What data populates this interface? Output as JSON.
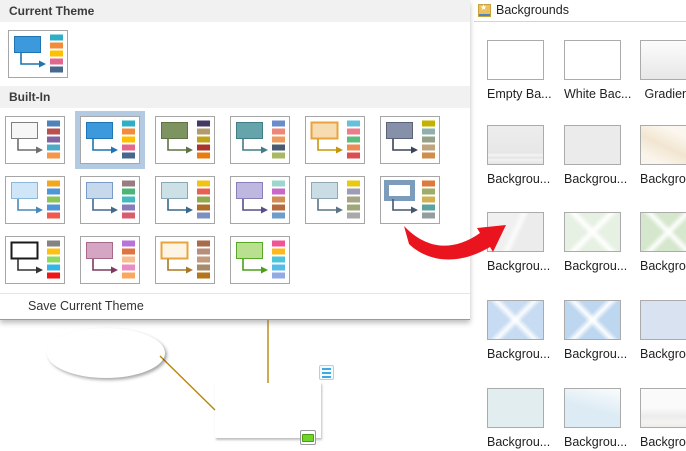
{
  "ui_colors": {
    "selection_highlight": "#b3cae3",
    "section_header_bg": "#f1f1f1",
    "right_separator": "#c9d6e4",
    "annotation_red": "#e9141d"
  },
  "left_panel": {
    "current_theme_header": "Current Theme",
    "built_in_header": "Built-In",
    "save_label": "Save Current Theme",
    "current_theme": {
      "box": "#3b99dc",
      "box_border": "#1f74b1",
      "arrow": "#1f74b1",
      "bars": [
        "#2eafc4",
        "#f08c3c",
        "#ffc000",
        "#e2688e",
        "#47678c"
      ]
    },
    "rows": [
      [
        {
          "box": "#f6f6f6",
          "box_border": "#7f7f7f",
          "arrow": "#6e6e6e",
          "bars": [
            "#4f81bd",
            "#b9504d",
            "#8064a2",
            "#4bacc6",
            "#f79646"
          ]
        },
        {
          "box": "#3b99dc",
          "box_border": "#1f74b1",
          "arrow": "#1f74b1",
          "bars": [
            "#2eafc4",
            "#f08c3c",
            "#ffc000",
            "#e2688e",
            "#47678c"
          ],
          "selected": true
        },
        {
          "box": "#7d9460",
          "box_border": "#5e7244",
          "arrow": "#5e7244",
          "bars": [
            "#453864",
            "#b29b6c",
            "#c0a41c",
            "#a8342c",
            "#e87c10"
          ]
        },
        {
          "box": "#64a4aa",
          "box_border": "#417d84",
          "arrow": "#417d84",
          "bars": [
            "#6a8ccb",
            "#ee8778",
            "#ee9a5c",
            "#475a70",
            "#a9b865"
          ]
        },
        {
          "box": "#f7dcb1",
          "box_border": "#e8a33d",
          "arrow": "#c8960c",
          "bars": [
            "#66c0dc",
            "#ef7b8b",
            "#5bbd7e",
            "#ef8a53",
            "#d94f53"
          ],
          "border2": true
        },
        {
          "box": "#8690a8",
          "box_border": "#5a6378",
          "arrow": "#3a4458",
          "bars": [
            "#c4b200",
            "#8fb0ac",
            "#95a188",
            "#bfa57e",
            "#ce8e4e"
          ]
        }
      ],
      [
        {
          "box": "#cfe6f8",
          "box_border": "#8cb8d8",
          "arrow": "#4888b8",
          "bars": [
            "#f2a71c",
            "#4e95d9",
            "#8cc455",
            "#4e95d9",
            "#f2594e"
          ]
        },
        {
          "box": "#c6d8ec",
          "box_border": "#7a9cc4",
          "arrow": "#44688c",
          "bars": [
            "#997c80",
            "#4bb578",
            "#46b8c0",
            "#8a7ab8",
            "#d95c6c"
          ]
        },
        {
          "box": "#cde0e6",
          "box_border": "#88a8b8",
          "arrow": "#3a6888",
          "bars": [
            "#efc319",
            "#e66055",
            "#93a94d",
            "#ae6e28",
            "#7c8fc2"
          ]
        },
        {
          "box": "#beb8e0",
          "box_border": "#8880b8",
          "arrow": "#584e88",
          "bars": [
            "#9cd6ce",
            "#c868c8",
            "#d08e52",
            "#b56a3f",
            "#6e9ccb"
          ]
        },
        {
          "box": "#cbdde4",
          "box_border": "#90a8b4",
          "arrow": "#5a7484",
          "bars": [
            "#e9c912",
            "#9d9db8",
            "#a6a687",
            "#9da878",
            "#a9a9a9"
          ]
        },
        {
          "box": "#ffffff",
          "box_border": "#7c9cbc",
          "arrow": "#44586c",
          "bars": [
            "#dd7b3e",
            "#9dad6a",
            "#d0b154",
            "#5ba3a0",
            "#949d9e"
          ],
          "thick": true
        }
      ],
      [
        {
          "box": "#ffffff",
          "box_border": "#1a1a1a",
          "arrow": "#333333",
          "bars": [
            "#838383",
            "#ffc010",
            "#8ed95f",
            "#33b5e7",
            "#f41414"
          ],
          "border2": true
        },
        {
          "box": "#d4a6c4",
          "box_border": "#a86888",
          "arrow": "#7e3a5e",
          "bars": [
            "#b873d8",
            "#e0733f",
            "#f7bc8f",
            "#e98cc0",
            "#f9a85f"
          ]
        },
        {
          "box": "#fdf4e3",
          "box_border": "#e8a33d",
          "arrow": "#a87828",
          "bars": [
            "#a96b4b",
            "#b78d7c",
            "#c29a7c",
            "#a58a6b",
            "#b5761b"
          ],
          "border2": true
        },
        {
          "box": "#b9e08e",
          "box_border": "#58a828",
          "arrow": "#4aa018",
          "bars": [
            "#f05498",
            "#ffb81c",
            "#4ec4dc",
            "#57bbe8",
            "#93abe4"
          ]
        }
      ]
    ]
  },
  "right_panel": {
    "title": "Backgrounds",
    "icon": "star-picture-icon",
    "items": [
      {
        "label": "Empty Ba...",
        "style": "empty"
      },
      {
        "label": "White Bac...",
        "style": "white"
      },
      {
        "label": "Gradient",
        "style": "gradient"
      },
      {
        "label": "Backgrou...",
        "style": "gray-lines"
      },
      {
        "label": "Backgrou...",
        "style": "gray"
      },
      {
        "label": "Backgrou...",
        "style": "cream"
      },
      {
        "label": "Backgrou...",
        "style": "gray-diag"
      },
      {
        "label": "Backgrou...",
        "style": "green-burst"
      },
      {
        "label": "Backgrou...",
        "style": "green-burst2"
      },
      {
        "label": "Backgrou...",
        "style": "blue-burst"
      },
      {
        "label": "Backgrou...",
        "style": "blue-burst2"
      },
      {
        "label": "Backgrou...",
        "style": "periwinkle"
      },
      {
        "label": "Backgrou...",
        "style": "cyan"
      },
      {
        "label": "Backgrou...",
        "style": "blue-rays"
      },
      {
        "label": "Backgrou...",
        "style": "gray-clouds"
      }
    ]
  },
  "canvas": {
    "ellipse": {
      "label": "Subject Id",
      "fill": "#b5850b"
    },
    "rect": {
      "label": "Subject",
      "fill": "#a5506c"
    },
    "connector_color": "#b8860b",
    "icons": {
      "list_icon_color": "#3fa9e0",
      "fill_icon_color": "#6fd629"
    }
  }
}
